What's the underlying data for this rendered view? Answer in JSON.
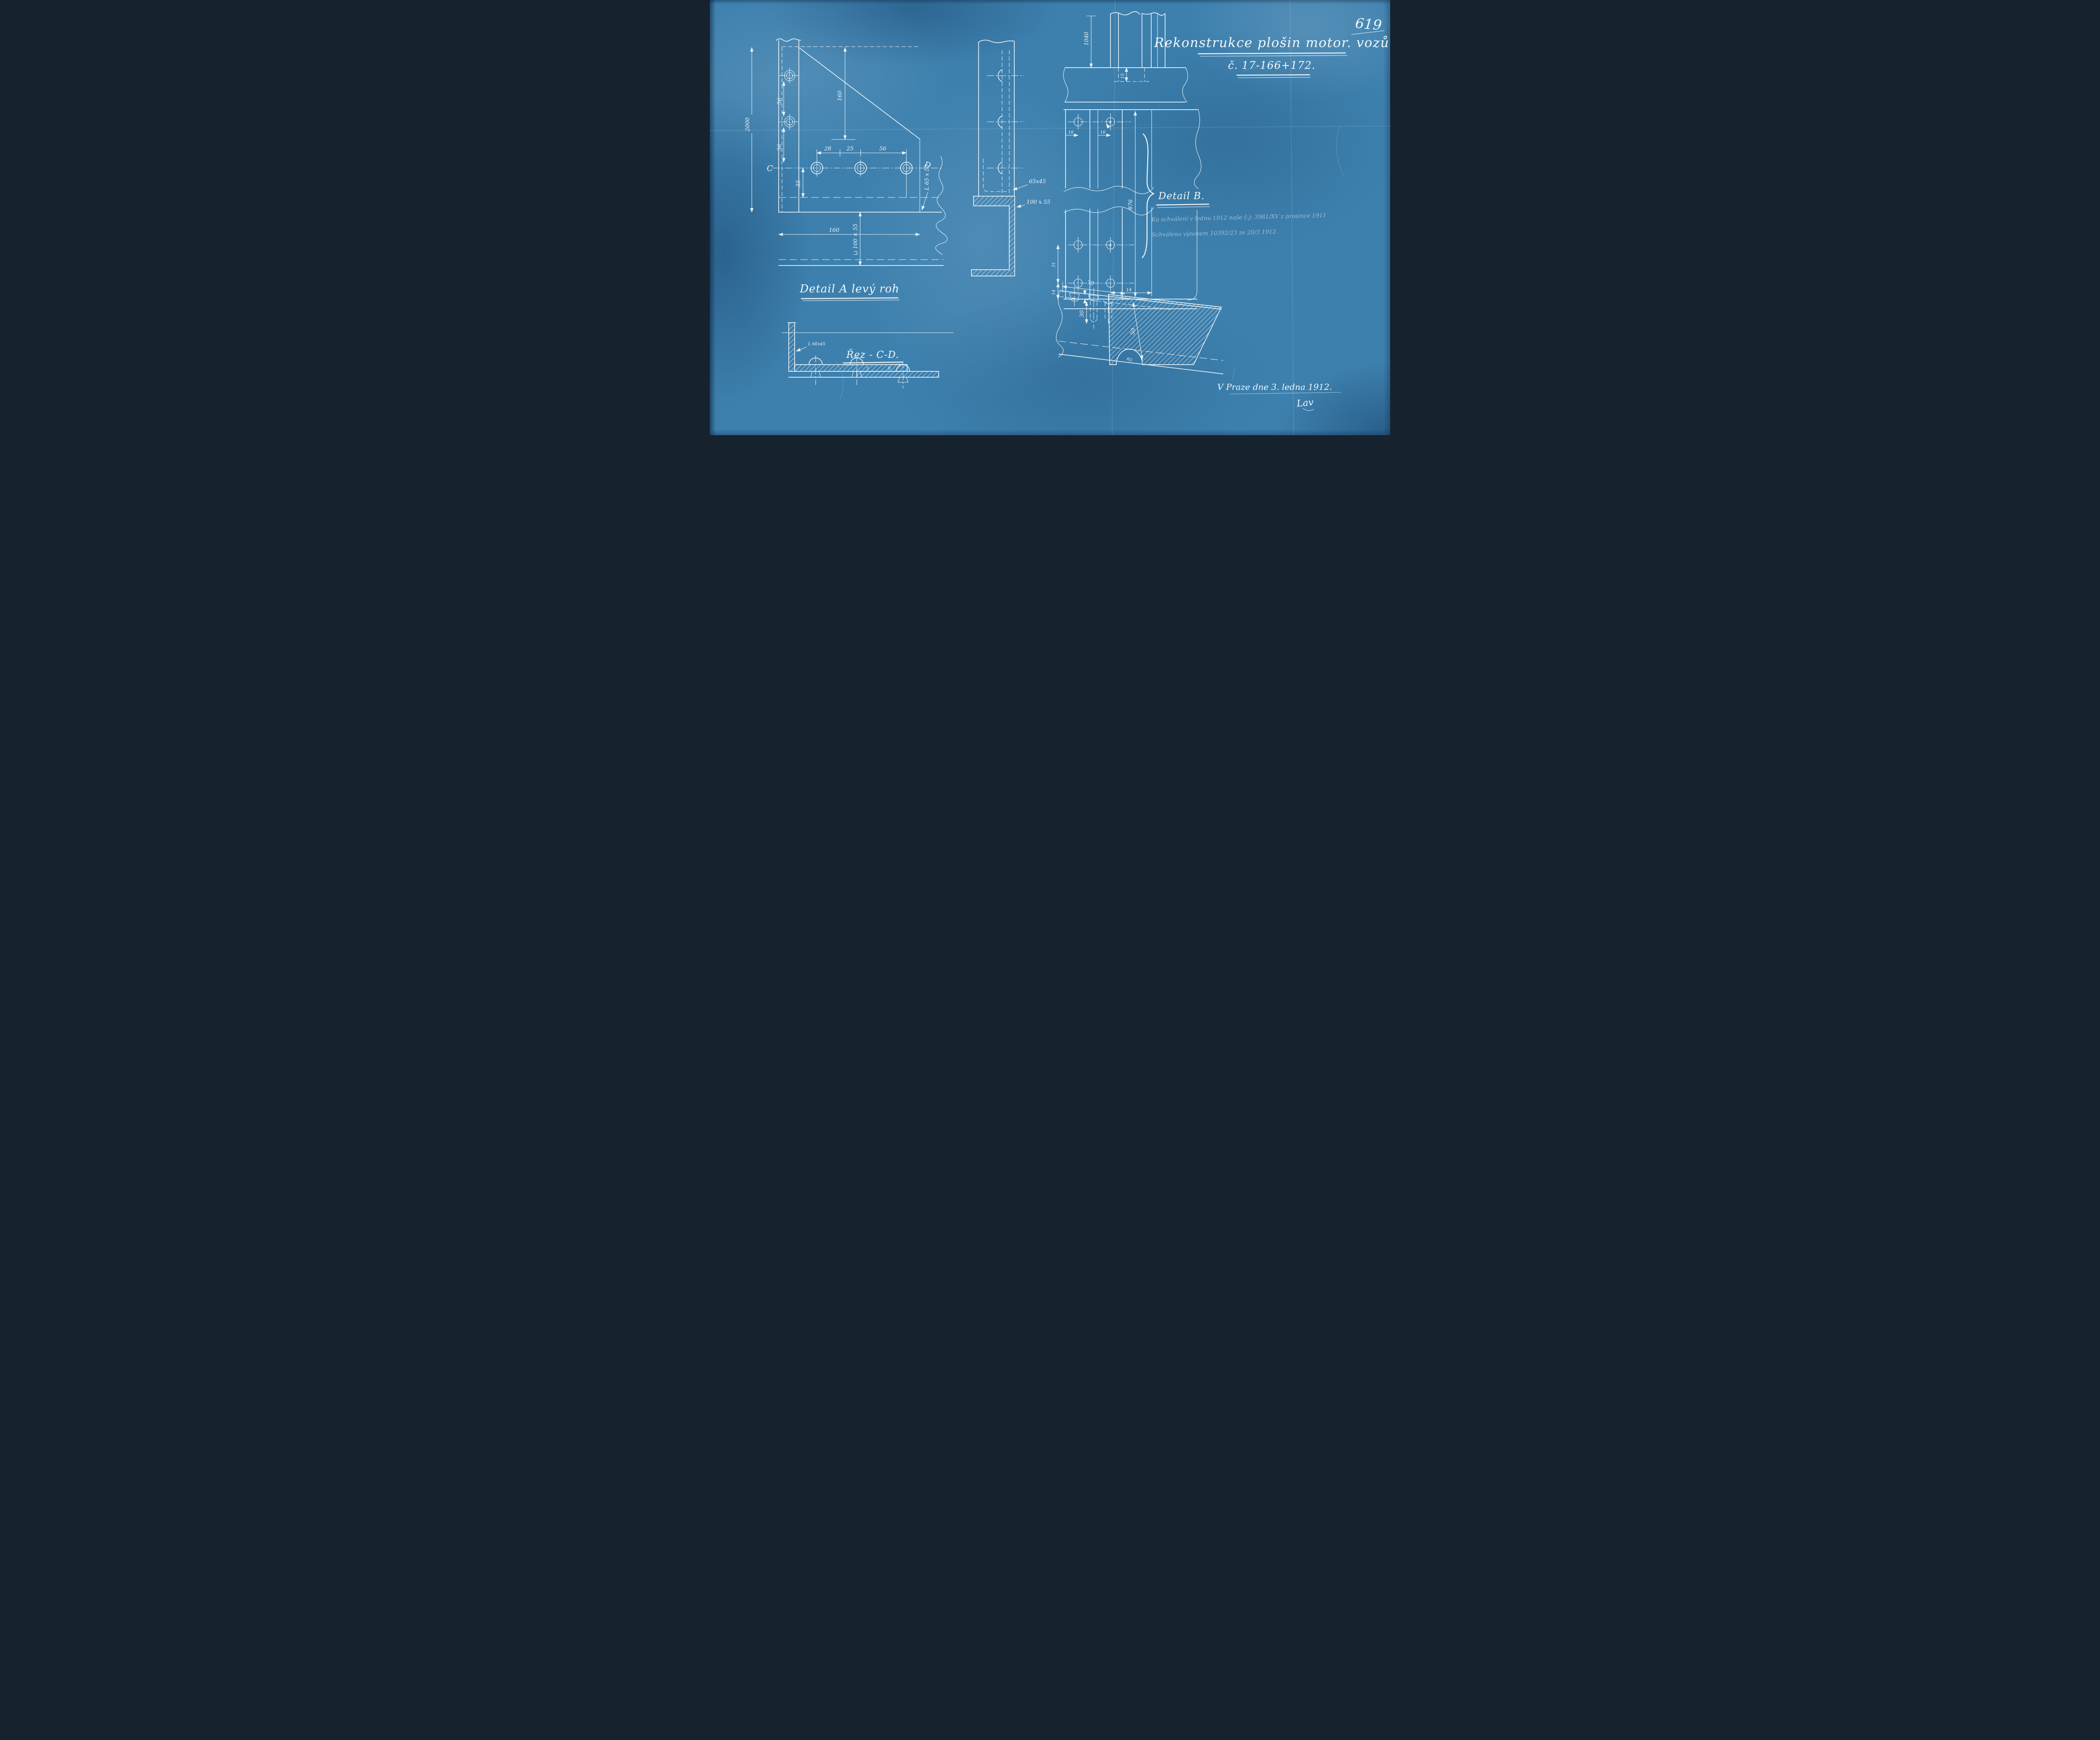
{
  "sheet": {
    "number": "619",
    "title_line1": "Rekonstrukce plošin motor. vozů",
    "title_line2": "č. 17-166+172.",
    "place_date": "V Praze dne 3. ledna 1912.",
    "signature": "Lav",
    "approval_line1": "Ku schválení v lednu 1912 naše č.j: 3981/XV z prosince 1911",
    "approval_line2": "Schváleno výnosem 10392/23 ze 20/3 1912.",
    "colors": {
      "paper": "#3d80ae",
      "ink": "#e9f3f7"
    }
  },
  "detail_a": {
    "label": "Detail A levý roh",
    "letter_c": "C",
    "letter_d": "D",
    "dims": {
      "d2000": "2000",
      "d56a": "56",
      "d56b": "56",
      "d28": "28",
      "d25": "25",
      "d56c": "56",
      "d35": "35",
      "d160v": "160",
      "d160h": "160",
      "angle_label": "L 65 x 50",
      "channel_label": "⊔ 100 × 55"
    }
  },
  "side_view": {
    "labels": {
      "angle": "65x45",
      "channel": "100 x 55"
    }
  },
  "detail_b": {
    "label": "Detail B.",
    "dims": {
      "d1040": "1040",
      "d15": "15",
      "d16a": "16",
      "d16b": "16",
      "d9a": "9",
      "d876": "876",
      "d31": "31",
      "d14a": "14",
      "d14b": "14",
      "d9b": "9"
    }
  },
  "section_cd": {
    "label": "Řez - C-D.",
    "angle_label": "L 60x45",
    "dims": {
      "d3": "3",
      "d8": "8"
    }
  },
  "edge_section": {
    "dims": {
      "d70": "70",
      "d2": "2",
      "d30": "30",
      "d50": "50",
      "d65": "65"
    }
  }
}
